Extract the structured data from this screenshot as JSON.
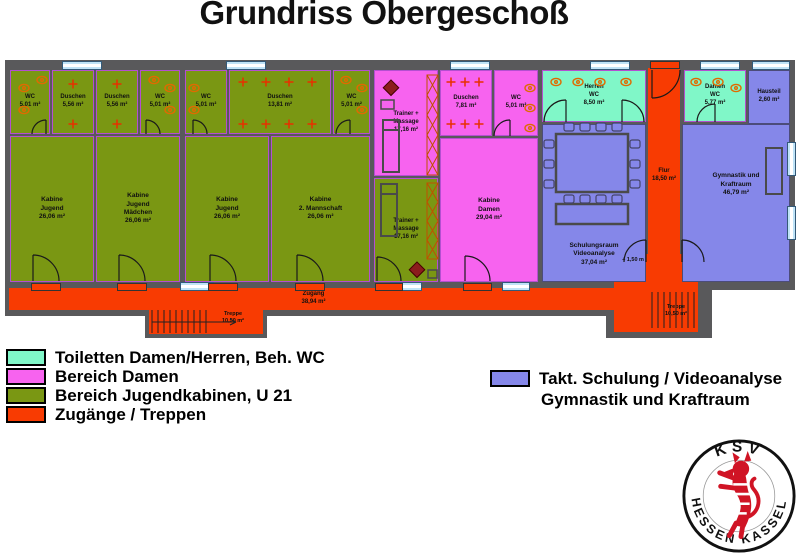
{
  "title": "Grundriss Obergeschoß",
  "legend": {
    "items": [
      {
        "label": "Toiletten Damen/Herren, Beh. WC",
        "color": "#80f7c8"
      },
      {
        "label": "Bereich Damen",
        "color": "#f763ef"
      },
      {
        "label": "Bereich Jugendkabinen, U 21",
        "color": "#7a9713"
      },
      {
        "label": "Zugänge / Treppen",
        "color": "#f83b02"
      }
    ]
  },
  "legend2": {
    "color": "#8587e9",
    "line1": "Takt. Schulung / Videoanalyse",
    "line2": "Gymnastik und Kraftraum"
  },
  "rooms": {
    "wc1": "WC\n5,01 m²",
    "du1": "Duschen\n5,56 m²",
    "du2": "Duschen\n5,56 m²",
    "wc2": "WC\n5,01 m²",
    "wc3": "WC\n5,01 m²",
    "du3": "Duschen\n13,81 m²",
    "wc4": "WC\n5,01 m²",
    "kab1": "Kabine\nJugend\n26,06 m²",
    "kab2": "Kabine\nJugend\nMädchen\n26,06 m²",
    "kab3": "Kabine\nJugend\n26,06 m²",
    "kab4": "Kabine\n2. Mannschaft\n26,06 m²",
    "trainer_pink": "Trainer +\nMassage\n17,16 m²",
    "trainer_gruen": "Trainer +\nMassage\n17,16 m²",
    "du_damen": "Duschen\n7,81 m²",
    "wc_damen": "WC\n5,01 m²",
    "kab_damen": "Kabine\nDamen\n29,04 m²",
    "herren_wc": "Herren\nWC\n8,50 m²",
    "damen_wc": "Damen\nWC\n5,77 m²",
    "hausteil": "Hausteil\n2,60 m²",
    "schulung": "Schulungsraum\nVideoanalyse\n37,04 m²",
    "gymnastik": "Gymnastik und\nKraftraum\n46,79 m²",
    "flur": "Flur\n18,50 m²",
    "zugang": "Zugang\n38,94 m²",
    "treppe1": "Treppe\n10,50 m²",
    "treppe2": "Treppe\n10,50 m²",
    "level_marker": "+ 1,50 m"
  },
  "logo": {
    "top": "KSV",
    "bottom_left": "HESSEN",
    "bottom_right": "KASSEL"
  },
  "colors": {
    "wall": "#59595b",
    "olive": "#7a9713",
    "pink": "#f763ef",
    "mint": "#80f7c8",
    "blue": "#8587e9",
    "orange": "#f83b02",
    "room_outline": "#b44fd0",
    "lion_red": "#d01425"
  }
}
